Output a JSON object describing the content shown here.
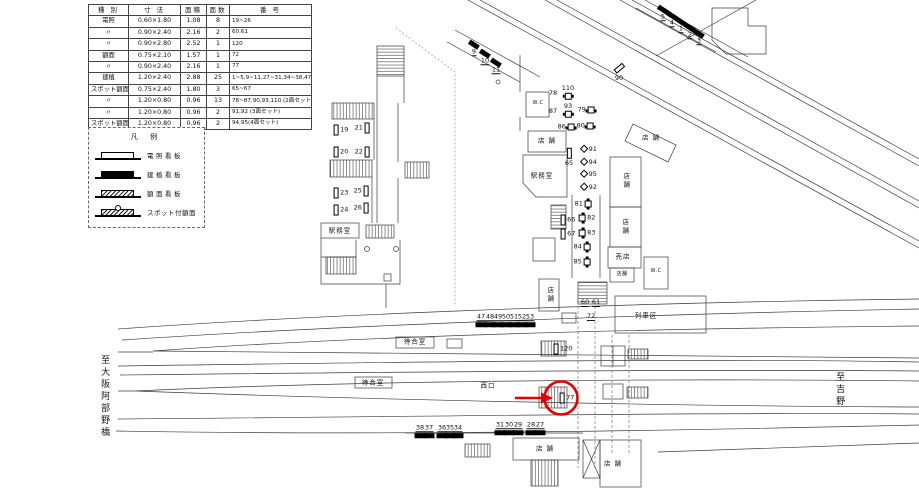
{
  "table": {
    "headers": [
      "種 別",
      "寸 法",
      "面積",
      "面数",
      "番 号"
    ],
    "rows": [
      [
        "電照",
        "0.60×1.80",
        "1.08",
        "8",
        "19~26"
      ],
      [
        "〃",
        "0.90×2.40",
        "2.16",
        "2",
        "60,61"
      ],
      [
        "〃",
        "0.90×2.80",
        "2.52",
        "1",
        "120"
      ],
      [
        "額面",
        "0.75×2.10",
        "1.57",
        "1",
        "72"
      ],
      [
        "〃",
        "0.90×2.40",
        "2.16",
        "1",
        "77"
      ],
      [
        "建植",
        "1.20×2.40",
        "2.88",
        "25",
        "1~5,9~11,27~31,34~38,47~53"
      ],
      [
        "スポット額面",
        "0.75×2.40",
        "1.80",
        "3",
        "65~67"
      ],
      [
        "〃",
        "1.20×0.80",
        "0.96",
        "13",
        "78~87,90,93,110 (2面セット)"
      ],
      [
        "〃",
        "1.20×0.80",
        "0.96",
        "2",
        "91,92 (3面セット)"
      ],
      [
        "スポット額面",
        "1.20×0.80",
        "0.96",
        "2",
        "94,95(4面セット)"
      ]
    ]
  },
  "legend": {
    "title": "凡 例",
    "items": [
      {
        "icon": "illuminated-sign-icon",
        "style": "",
        "label": "電照看板"
      },
      {
        "icon": "standing-sign-icon",
        "style": "black",
        "label": "建植看板"
      },
      {
        "icon": "face-sign-icon",
        "style": "hatch",
        "label": "額面看板"
      },
      {
        "icon": "spot-face-sign-icon",
        "style": "hatch spot",
        "label": "スポット付額面",
        "tight": 1
      }
    ]
  },
  "map": {
    "highlight_color": "#e10000",
    "highlighted_sign": "77",
    "labels": [
      {
        "t": "W.C",
        "x": 538,
        "y": 104,
        "c": "sm"
      },
      {
        "t": "店 舗",
        "x": 547,
        "y": 141
      },
      {
        "t": "駅務室",
        "x": 542,
        "y": 176
      },
      {
        "t": "店舗",
        "x": 625,
        "y": 181,
        "c": "v"
      },
      {
        "t": "店舗",
        "x": 624,
        "y": 227,
        "c": "v"
      },
      {
        "t": "売店",
        "x": 623,
        "y": 257
      },
      {
        "t": "W.C",
        "x": 656,
        "y": 272,
        "c": "sm"
      },
      {
        "t": "店 舗",
        "x": 651,
        "y": 138
      },
      {
        "t": "店舗",
        "x": 549,
        "y": 295,
        "c": "v"
      },
      {
        "t": "店舗",
        "x": 622,
        "y": 275,
        "c": "sm"
      },
      {
        "t": "列車区",
        "x": 646,
        "y": 316
      },
      {
        "t": "待合室",
        "x": 415,
        "y": 342
      },
      {
        "t": "待合室",
        "x": 373,
        "y": 383
      },
      {
        "t": "西口",
        "x": 488,
        "y": 386
      },
      {
        "t": "店 舗",
        "x": 545,
        "y": 449
      },
      {
        "t": "店 舗",
        "x": 613,
        "y": 464
      },
      {
        "t": "駅務室",
        "x": 340,
        "y": 231
      },
      {
        "t": "至大阪阿部野橋",
        "x": 104,
        "y": 397,
        "c": "v big"
      },
      {
        "t": "至吉野",
        "x": 839,
        "y": 390,
        "c": "v big"
      }
    ],
    "markers": [
      {
        "n": "19",
        "sym": "vr",
        "x": 341,
        "y": 130,
        "side": "r"
      },
      {
        "n": "21",
        "sym": "vr",
        "x": 362,
        "y": 128,
        "side": "l"
      },
      {
        "n": "20",
        "sym": "vr",
        "x": 341,
        "y": 152,
        "side": "r"
      },
      {
        "n": "22",
        "sym": "vr",
        "x": 362,
        "y": 152,
        "side": "l"
      },
      {
        "n": "23",
        "sym": "vr",
        "x": 341,
        "y": 193,
        "side": "r"
      },
      {
        "n": "25",
        "sym": "vr",
        "x": 361,
        "y": 191,
        "side": "l"
      },
      {
        "n": "24",
        "sym": "vr",
        "x": 341,
        "y": 210,
        "side": "r"
      },
      {
        "n": "26",
        "sym": "vr",
        "x": 361,
        "y": 208,
        "side": "l"
      },
      {
        "n": "9",
        "sym": "bar",
        "rot": 33,
        "x": 474,
        "y": 49,
        "side": "b",
        "u": 1
      },
      {
        "n": "10",
        "sym": "bar",
        "rot": 33,
        "x": 485,
        "y": 58,
        "side": "b",
        "u": 1
      },
      {
        "n": "11",
        "sym": "bar",
        "rot": 33,
        "x": 496,
        "y": 67,
        "side": "b",
        "u": 1
      },
      {
        "n": "5",
        "sym": "bar",
        "rot": 33,
        "x": 663,
        "y": 14,
        "side": "b",
        "u": 1
      },
      {
        "n": "4",
        "sym": "bar",
        "rot": 33,
        "x": 672,
        "y": 20,
        "side": "b",
        "u": 1
      },
      {
        "n": "1",
        "sym": "bar",
        "rot": 33,
        "x": 681,
        "y": 26,
        "side": "b",
        "u": 1
      },
      {
        "n": "2",
        "sym": "bar",
        "rot": 33,
        "x": 690,
        "y": 32,
        "side": "b",
        "u": 1
      },
      {
        "n": "3",
        "sym": "bar",
        "rot": 33,
        "x": 699,
        "y": 38,
        "side": "b",
        "u": 1
      },
      {
        "n": "90",
        "sym": "vr",
        "rot": 50,
        "x": 619,
        "y": 72,
        "side": "b"
      },
      {
        "n": "110",
        "sym": "sq",
        "x": 568,
        "y": 92,
        "side": "t"
      },
      {
        "n": "78",
        "sym": "txt",
        "x": 553,
        "y": 93,
        "side": "l"
      },
      {
        "n": "93",
        "sym": "sq",
        "x": 568,
        "y": 110,
        "side": "t"
      },
      {
        "n": "87",
        "sym": "txt",
        "x": 553,
        "y": 111,
        "side": "l"
      },
      {
        "n": "79",
        "sym": "sq",
        "x": 586,
        "y": 110,
        "side": "l"
      },
      {
        "n": "86",
        "sym": "sq",
        "x": 566,
        "y": 127,
        "side": "l"
      },
      {
        "n": "80",
        "sym": "sq",
        "x": 585,
        "y": 126,
        "side": "l"
      },
      {
        "n": "91",
        "sym": "dia",
        "x": 589,
        "y": 149,
        "side": "r"
      },
      {
        "n": "94",
        "sym": "dia",
        "x": 589,
        "y": 162,
        "side": "r"
      },
      {
        "n": "95",
        "sym": "dia",
        "x": 589,
        "y": 174,
        "side": "r"
      },
      {
        "n": "92",
        "sym": "dia",
        "x": 589,
        "y": 187,
        "side": "r"
      },
      {
        "n": "65",
        "sym": "vr",
        "x": 569,
        "y": 157,
        "side": "b"
      },
      {
        "n": "66",
        "sym": "vr",
        "x": 568,
        "y": 220,
        "side": "r"
      },
      {
        "n": "67",
        "sym": "vr",
        "x": 568,
        "y": 234,
        "side": "r"
      },
      {
        "n": "81",
        "sym": "sq2",
        "x": 583,
        "y": 204,
        "side": "l"
      },
      {
        "n": "82",
        "sym": "sq2",
        "x": 587,
        "y": 218,
        "side": "r"
      },
      {
        "n": "83",
        "sym": "sq2",
        "x": 587,
        "y": 233,
        "side": "r"
      },
      {
        "n": "84",
        "sym": "sq2",
        "x": 582,
        "y": 247,
        "side": "l"
      },
      {
        "n": "85",
        "sym": "sq2",
        "x": 582,
        "y": 262,
        "side": "l"
      },
      {
        "n": "60",
        "sym": "txt",
        "x": 585,
        "y": 303,
        "side": "l",
        "u": 1
      },
      {
        "n": "61",
        "sym": "txt",
        "x": 596,
        "y": 303,
        "side": "l",
        "u": 1
      },
      {
        "n": "72",
        "sym": "txt",
        "x": 591,
        "y": 317,
        "side": "l",
        "u": 1
      },
      {
        "n": "120",
        "sym": "vr",
        "x": 563,
        "y": 349,
        "side": "r"
      },
      {
        "n": "77",
        "sym": "vr",
        "x": 567,
        "y": 398,
        "side": "r"
      },
      {
        "n": "47",
        "sym": "bar",
        "x": 481,
        "y": 320,
        "side": "t",
        "u": 1
      },
      {
        "n": "48",
        "sym": "bar",
        "x": 490,
        "y": 320,
        "side": "t",
        "u": 1
      },
      {
        "n": "49",
        "sym": "bar",
        "x": 498,
        "y": 320,
        "side": "t",
        "u": 1
      },
      {
        "n": "50",
        "sym": "bar",
        "x": 506,
        "y": 320,
        "side": "t",
        "u": 1
      },
      {
        "n": "51",
        "sym": "bar",
        "x": 514,
        "y": 320,
        "side": "t",
        "u": 1
      },
      {
        "n": "52",
        "sym": "bar",
        "x": 522,
        "y": 320,
        "side": "t",
        "u": 1
      },
      {
        "n": "53",
        "sym": "bar",
        "x": 530,
        "y": 320,
        "side": "t",
        "u": 1
      },
      {
        "n": "38",
        "sym": "bar",
        "x": 420,
        "y": 431,
        "side": "t",
        "u": 1
      },
      {
        "n": "37",
        "sym": "bar",
        "x": 429,
        "y": 431,
        "side": "t",
        "u": 1
      },
      {
        "n": "36",
        "sym": "bar",
        "x": 442,
        "y": 431,
        "side": "t",
        "u": 1
      },
      {
        "n": "35",
        "sym": "bar",
        "x": 450,
        "y": 431,
        "side": "t",
        "u": 1
      },
      {
        "n": "34",
        "sym": "bar",
        "x": 458,
        "y": 431,
        "side": "t",
        "u": 1
      },
      {
        "n": "31",
        "sym": "bar",
        "x": 500,
        "y": 428,
        "side": "t",
        "u": 1
      },
      {
        "n": "30",
        "sym": "bar",
        "x": 509,
        "y": 428,
        "side": "t",
        "u": 1
      },
      {
        "n": "29",
        "sym": "bar",
        "x": 518,
        "y": 428,
        "side": "t",
        "u": 1
      },
      {
        "n": "28",
        "sym": "bar",
        "x": 531,
        "y": 428,
        "side": "t",
        "u": 1
      },
      {
        "n": "27",
        "sym": "bar",
        "x": 540,
        "y": 428,
        "side": "t",
        "u": 1
      }
    ]
  }
}
